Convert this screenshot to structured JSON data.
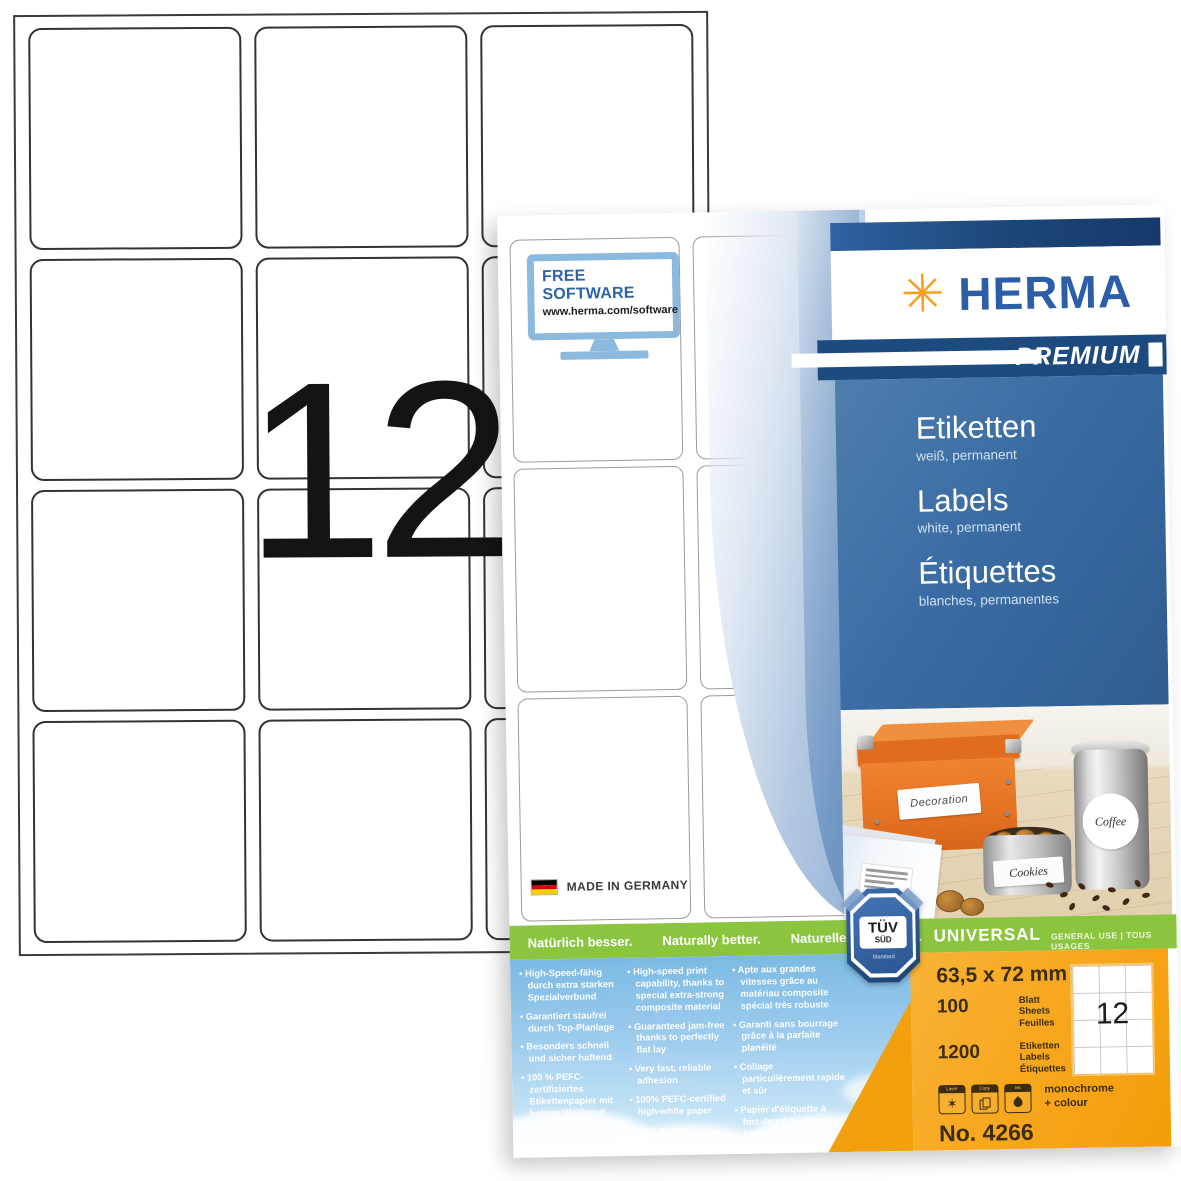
{
  "background_sheet": {
    "big_label_count": "12"
  },
  "package": {
    "free_software": {
      "title": "FREE SOFTWARE",
      "url": "www.herma.com/software"
    },
    "made_in": "MADE IN GERMANY",
    "brand": {
      "asterisk": "✳",
      "name": "HERMA",
      "tier": "PREMIUM"
    },
    "products": [
      {
        "title": "Etiketten",
        "subtitle": "weiß, permanent"
      },
      {
        "title": "Labels",
        "subtitle": "white, permanent"
      },
      {
        "title": "Étiquettes",
        "subtitle": "blanches, permanentes"
      }
    ],
    "photo": {
      "box_label": "Decoration",
      "canister_label": "Coffee",
      "tin_label": "Cookies"
    },
    "taglines": [
      "Natürlich besser.",
      "Naturally better.",
      "Naturellement mieux."
    ],
    "universal": {
      "title": "UNIVERSAL",
      "subtitle": "GENERAL USE | TOUS USAGES"
    },
    "tuv": {
      "line1": "TÜV",
      "line2": "SÜD",
      "footer": "Standard"
    },
    "bullets_de": [
      "High-Speed-fähig durch extra starken Spezial­verbund",
      "Garantiert staufrei durch Top-Planlage",
      "Besonders schnell und sicher haftend",
      "100 % PEFC-zertifizier­tes Etikettenpapier mit hohem Weißgrad",
      "Umweltschonend: ohne Chlorbleiche, säurefrei, lösemittelfrei"
    ],
    "bullets_en": [
      "High-speed print capa­bility, thanks to special extra-strong composite material",
      "Guaranteed jam-free thanks to perfectly flat lay",
      "Very fast, reliable adhesion",
      "100% PEFC-certified high-white paper",
      "Kind to the environment: chlorine-free bleached, acid and solvent-free"
    ],
    "bullets_fr": [
      "Apte aux grandes vitesses grâce au matériau compo­site spécial très robuste",
      "Garanti sans bourrage grâce à la parfaite planéité",
      "Collage particulièrement rapide et sûr",
      "Papier d'étiquette à fort-degré de blanc, certifié PEFC à 100 %",
      "Ménage l'environnement : sans blanchiment au chlore, ni acide, ni solvant"
    ],
    "specs": {
      "size": "63,5 x 72 mm",
      "sheets_qty": "100",
      "sheets_units": [
        "Blatt",
        "Sheets",
        "Feuilles"
      ],
      "labels_qty": "1200",
      "labels_units": [
        "Etiketten",
        "Labels",
        "Étiquettes"
      ],
      "printer_icons": [
        "Laser",
        "Copy",
        "Ink"
      ],
      "printing_line1": "monochrome",
      "printing_line2": "+ colour",
      "order_no": "No. 4266",
      "mini_sheet_count": "12"
    },
    "colors": {
      "herma_blue": "#2b5da8",
      "navy": "#1d4b80",
      "panel_blue": "#3a6ca3",
      "brand_orange": "#f6a01d",
      "panel_orange": "#f7a81f",
      "green": "#8bc53f"
    }
  }
}
